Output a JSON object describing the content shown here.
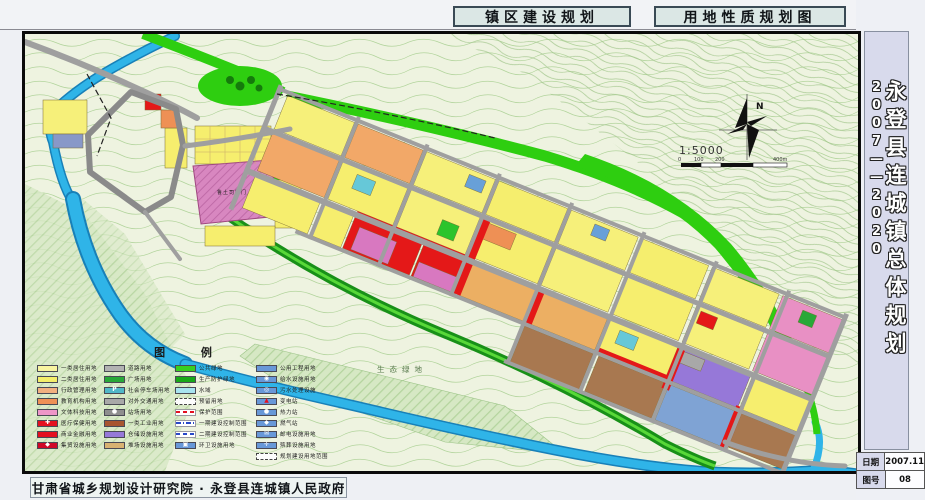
{
  "header": {
    "title_left": "镇区建设规划",
    "title_right": "用地性质规划图"
  },
  "sidebar": {
    "title": "永登县连城镇总体规划",
    "years": "2007——2020",
    "date_label": "日期",
    "date_value": "2007.11",
    "sheet_label": "图号",
    "sheet_value": "08"
  },
  "footer": {
    "credit": "甘肃省城乡规划设计研究院 · 永登县连城镇人民政府"
  },
  "map": {
    "north_label": "N",
    "scale_text": "1:5000",
    "scale_ticks": [
      "0",
      "100",
      "200",
      "400m"
    ],
    "labels": {
      "heritage": "鲁土司衙门",
      "eco_green": "生态绿地"
    }
  },
  "legend": {
    "title": "图 例",
    "columns": [
      [
        {
          "label": "一类居住用地",
          "color": "#f8f4a0",
          "style": "solid"
        },
        {
          "label": "二类居住用地",
          "color": "#f4ee6a",
          "style": "solid"
        },
        {
          "label": "行政管理用地",
          "color": "#f2b080",
          "style": "solid"
        },
        {
          "label": "教育机构用地",
          "color": "#ee9055",
          "style": "solid"
        },
        {
          "label": "文体科技用地",
          "color": "#ee96c8",
          "style": "solid"
        },
        {
          "label": "医疗保健用地",
          "color": "#e41020",
          "style": "solid",
          "glyph": "✚",
          "glyph_color": "#ffffff"
        },
        {
          "label": "商业金融用地",
          "color": "#e41020",
          "style": "solid"
        },
        {
          "label": "集贸设施用地",
          "color": "#d00828",
          "style": "solid",
          "glyph": "◆",
          "glyph_color": "#ffffff"
        }
      ],
      [
        {
          "label": "道路用地",
          "color": "#b2b2b2",
          "style": "solid"
        },
        {
          "label": "广场用地",
          "color": "#28a838",
          "style": "solid"
        },
        {
          "label": "社会停车场用地",
          "color": "#50b8c8",
          "style": "solid",
          "glyph": "P",
          "glyph_color": "#ffffff"
        },
        {
          "label": "对外交通用地",
          "color": "#a8a8a8",
          "style": "solid"
        },
        {
          "label": "站场用地",
          "color": "#8e8e8e",
          "style": "solid",
          "glyph": "●",
          "glyph_color": "#ffffff"
        },
        {
          "label": "一类工业用地",
          "color": "#a85530",
          "style": "solid"
        },
        {
          "label": "仓储设施用地",
          "color": "#9678d8",
          "style": "solid"
        },
        {
          "label": "堆场设施用地",
          "color": "#d8b272",
          "style": "solid"
        }
      ],
      [
        {
          "label": "公共绿地",
          "color": "#38d020",
          "style": "solid"
        },
        {
          "label": "生产防护绿地",
          "color": "#18a818",
          "style": "solid"
        },
        {
          "label": "水域",
          "color": "#a8e4f0",
          "style": "solid"
        },
        {
          "label": "预留用地",
          "color": "#ffffff",
          "style": "outline-dash"
        },
        {
          "label": "保护范围",
          "color": "#ffffff",
          "style": "line-red-dash"
        },
        {
          "label": "一期建设控制范围",
          "color": "#ffffff",
          "style": "line-blue-dashdot"
        },
        {
          "label": "二期建设控制范围",
          "color": "#ffffff",
          "style": "line-blue-dash"
        },
        {
          "label": "环卫设施用地",
          "color": "#6898d8",
          "style": "solid",
          "glyph": "▣",
          "glyph_color": "#ffffff"
        }
      ],
      [
        {
          "label": "公用工程用地",
          "color": "#6898d8",
          "style": "solid"
        },
        {
          "label": "给水设施用地",
          "color": "#6898d8",
          "style": "solid",
          "glyph": "◉",
          "glyph_color": "#ffffff"
        },
        {
          "label": "污水处理设施",
          "color": "#6898d8",
          "style": "solid",
          "glyph": "◎",
          "glyph_color": "#ffffff"
        },
        {
          "label": "变电站",
          "color": "#6898d8",
          "style": "solid",
          "glyph": "▲",
          "glyph_color": "#e41020"
        },
        {
          "label": "热力站",
          "color": "#6898d8",
          "style": "solid",
          "glyph": "●",
          "glyph_color": "#ffffff"
        },
        {
          "label": "燃气站",
          "color": "#6898d8",
          "style": "solid",
          "glyph": "◆",
          "glyph_color": "#ffffff"
        },
        {
          "label": "邮电设施用地",
          "color": "#6898d8",
          "style": "solid",
          "glyph": "✉",
          "glyph_color": "#ffffff"
        },
        {
          "label": "殡葬设施用地",
          "color": "#6898d8",
          "style": "solid",
          "glyph": "✛",
          "glyph_color": "#ffffff"
        },
        {
          "label": "规划建设用地范围",
          "color": "#ffffff",
          "style": "outline-dash"
        }
      ]
    ]
  },
  "colors": {
    "paper": "#eef0f4",
    "map_background": "#eef3e0",
    "contour_line": "#b2d49c",
    "river": "#2fb4e8",
    "road": "#9f9f9f",
    "green_space": "#2ece10",
    "residential": "#f6f07a",
    "commercial_red": "#e41818",
    "sidebar_panel": "#d8daec"
  }
}
